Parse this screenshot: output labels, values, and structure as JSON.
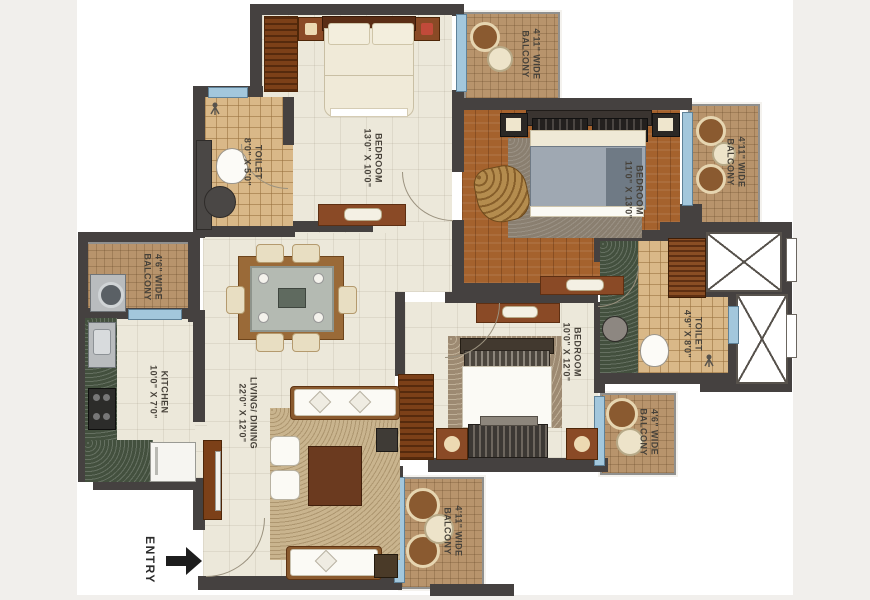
{
  "plan": {
    "type": "apartment-floor-plan",
    "background": "#f1efec",
    "sheet_color": "#ffffff"
  },
  "colors": {
    "wall": "#454140",
    "cream": "#ece8da",
    "tan": "#d9b888",
    "wood": "#a5622d",
    "balc": "#b8946c",
    "green": "#43503e",
    "winblue": "#a3c7dc",
    "brown": "#7c4018",
    "label": "#47423a"
  },
  "rooms": [
    {
      "name": "toilet-1",
      "label": "TOILET",
      "dims": "8'0\" X 5'0\""
    },
    {
      "name": "bedroom-1",
      "label": "BEDROOM",
      "dims": "13'0\" X 10'0\""
    },
    {
      "name": "balcony-top",
      "label": "4'11\" WIDE",
      "dims": "BALCONY"
    },
    {
      "name": "bedroom-master",
      "label": "BEDROOM",
      "dims": "11'0\" X 13'0\""
    },
    {
      "name": "balcony-master",
      "label": "4'11\" WIDE",
      "dims": "BALCONY"
    },
    {
      "name": "balcony-left",
      "label": "4'6\" WIDE",
      "dims": "BALCONY"
    },
    {
      "name": "kitchen",
      "label": "KITCHEN",
      "dims": "10'0\" X 7'0\""
    },
    {
      "name": "living-dining",
      "label": "LIVING/ DINING",
      "dims": "22'0\" X 12'0\""
    },
    {
      "name": "bedroom-3",
      "label": "BEDROOM",
      "dims": "10'0\" X 12'0\""
    },
    {
      "name": "toilet-2",
      "label": "TOILET",
      "dims": "4'9\" X 8'0\""
    },
    {
      "name": "balcony-right",
      "label": "4'6\" WIDE",
      "dims": "BALCONY"
    },
    {
      "name": "balcony-bottom",
      "label": "4'11\" WIDE",
      "dims": "BALCONY"
    }
  ],
  "entry": {
    "label": "ENTRY"
  }
}
